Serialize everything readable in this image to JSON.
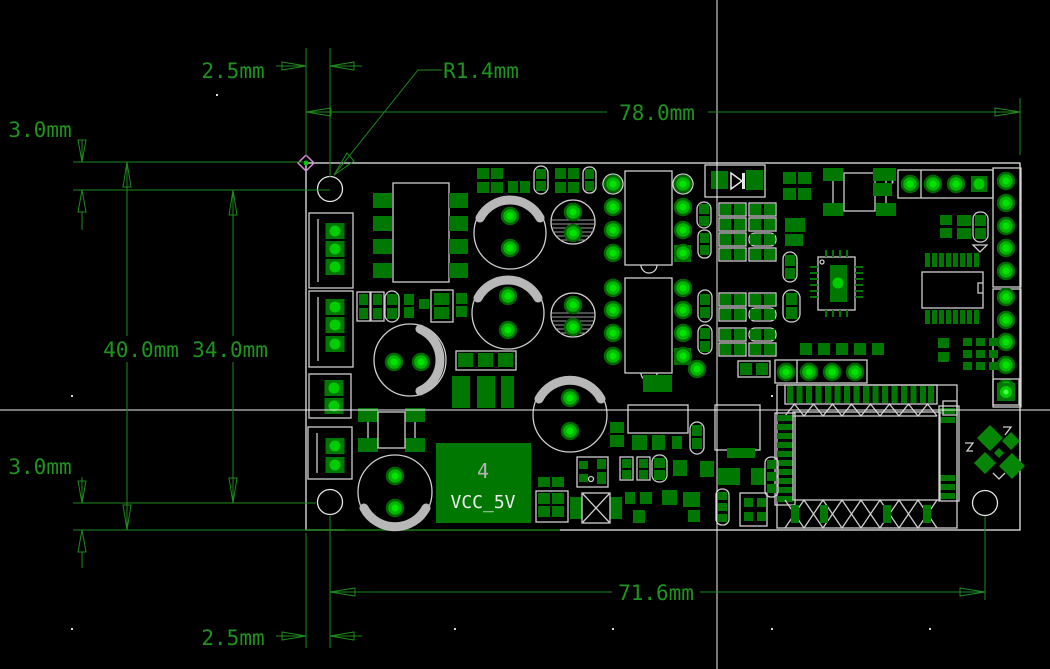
{
  "view": {
    "description": "PCB CAD dimension drawing on black canvas",
    "units": "mm"
  },
  "colors": {
    "background": "#000000",
    "dimension_green": "#1e941e",
    "pad_green": "#007700",
    "pad_bright_green": "#00c800",
    "silkscreen": "#cfcfcf",
    "crosshair": "#efefef"
  },
  "annotations": {
    "top_offset": "2.5mm",
    "corner_radius": "R1.4mm",
    "board_width": "78.0mm",
    "top_margin": "3.0mm",
    "overall_height": "40.0mm",
    "inner_height": "34.0mm",
    "bottom_margin": "3.0mm",
    "hole_span": "71.6mm",
    "bottom_offset": "2.5mm"
  },
  "board": {
    "power_module": {
      "designator": "4",
      "net": "VCC_5V"
    }
  }
}
